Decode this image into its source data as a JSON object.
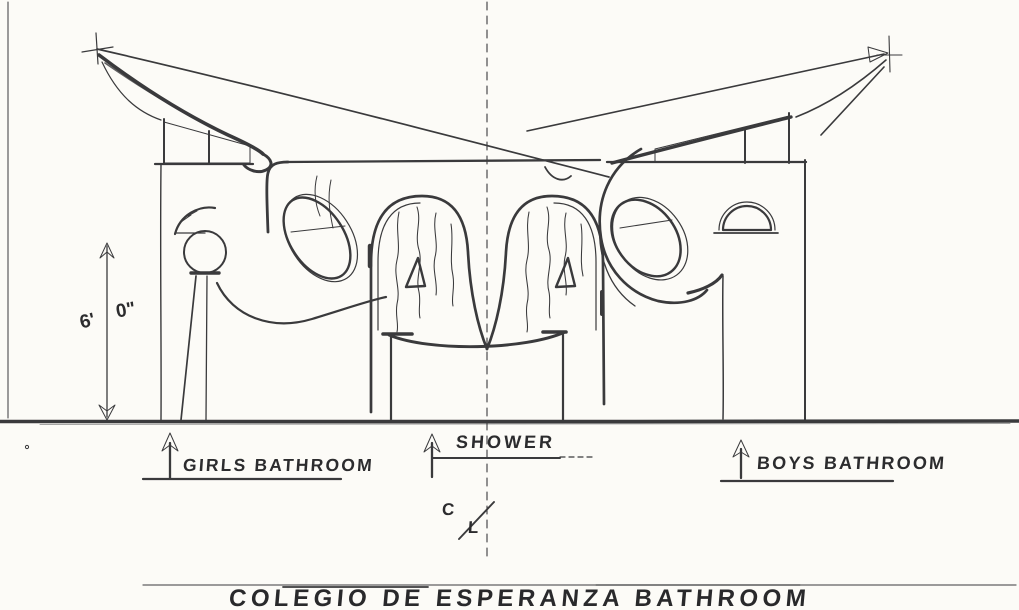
{
  "drawing": {
    "title": "COLEGIO DE ESPERANZA BATHROOM",
    "dimension": {
      "feet": "6'",
      "inches": "0\""
    },
    "labels": {
      "girls_bathroom": "GIRLS BATHROOM",
      "shower": "SHOWER",
      "boys_bathroom": "BOYS BATHROOM"
    },
    "centerline": {
      "top": "C",
      "bottom": "L"
    },
    "colors": {
      "ink": "#3a3a3c",
      "paper": "#fcfbf7",
      "pencil_guide": "#9a9a92"
    }
  }
}
